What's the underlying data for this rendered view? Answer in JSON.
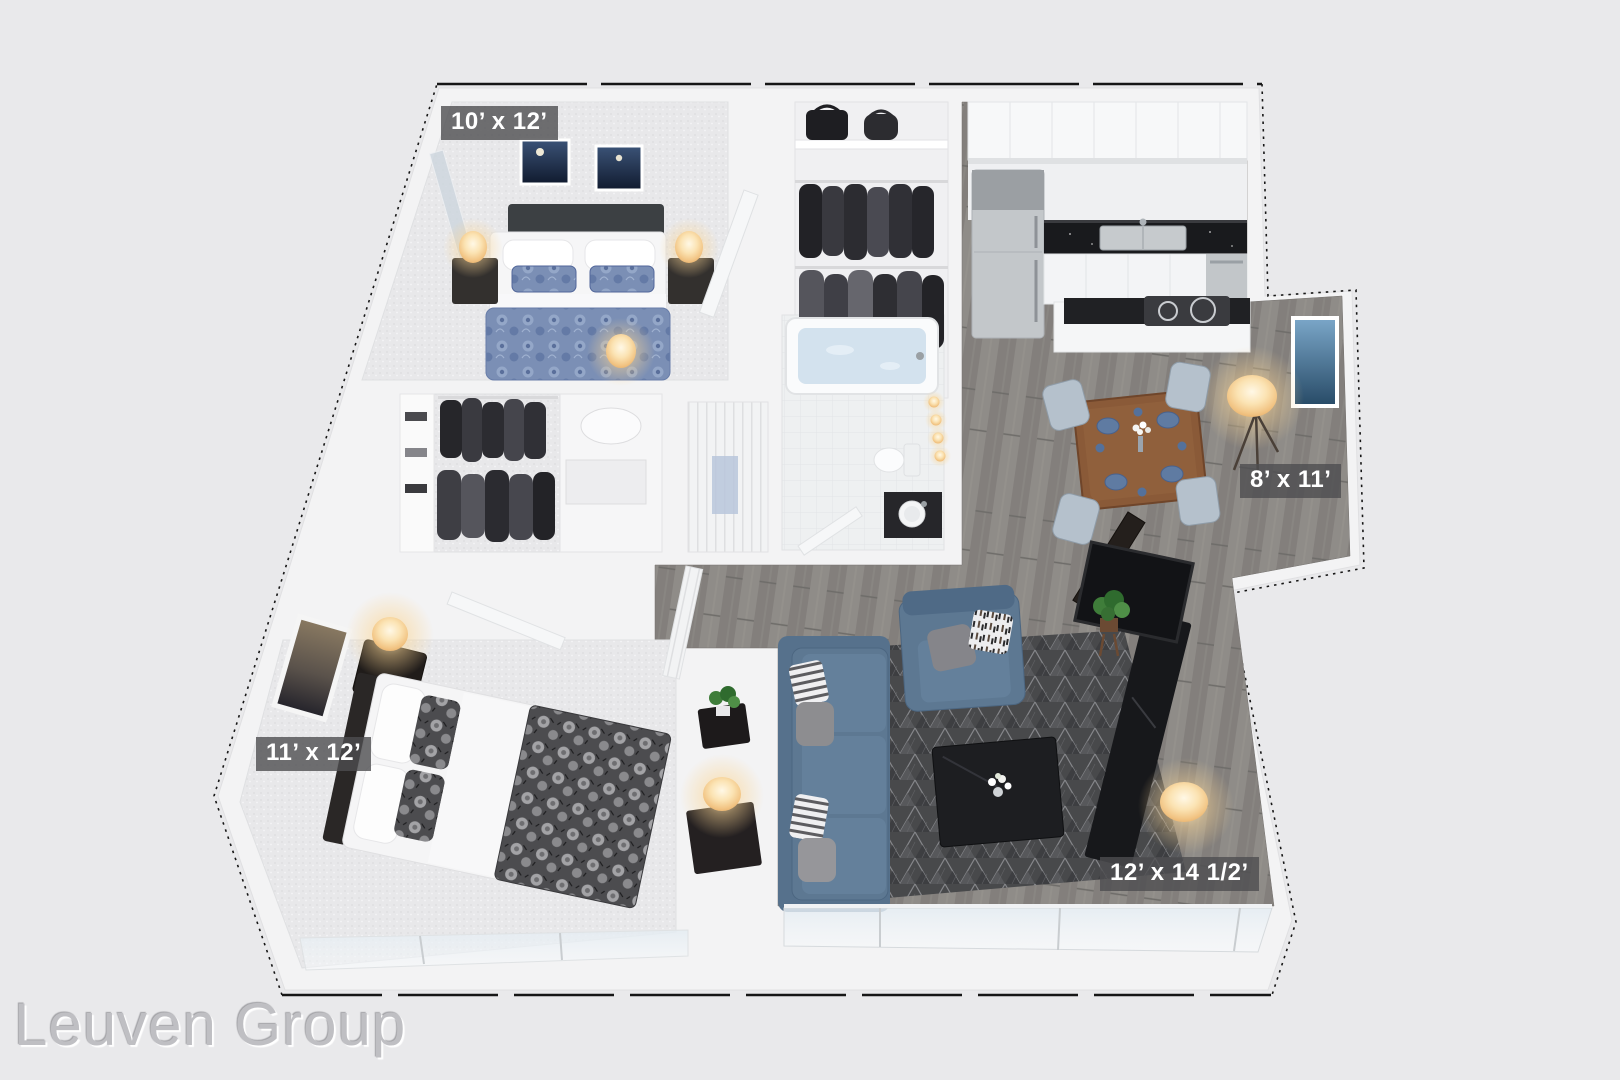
{
  "page": {
    "background_color": "#e9e9eb",
    "type": "3d-floor-plan-render"
  },
  "watermark": "Leuven Group",
  "labels": {
    "bedroom_top": "10’ x 12’",
    "dining": "8’ x 11’",
    "bedroom_bottom": "11’ x 12’",
    "living": "12’ x 14 1/2’"
  },
  "rooms": [
    {
      "id": "bedroom-top",
      "dimensions": "10’ x 12’"
    },
    {
      "id": "walk-in-closet",
      "dimensions": ""
    },
    {
      "id": "bathroom",
      "dimensions": ""
    },
    {
      "id": "kitchen",
      "dimensions": ""
    },
    {
      "id": "dining-nook",
      "dimensions": "8’ x 11’"
    },
    {
      "id": "bedroom-bottom",
      "dimensions": "11’ x 12’"
    },
    {
      "id": "living-room",
      "dimensions": "12’ x 14 1/2’"
    }
  ],
  "colors": {
    "wall": "#f3f3f4",
    "carpet": "#e8e8ea",
    "wood_floor": "#8d8a86",
    "rug": "#48494b",
    "sofa_blue": "#5d7892",
    "counter_black": "#1c1d20",
    "table_wood": "#8a5a38",
    "lamp_glow": "#f9d9a0",
    "label_background": "rgba(78,78,80,0.8)",
    "label_text": "#ffffff"
  }
}
